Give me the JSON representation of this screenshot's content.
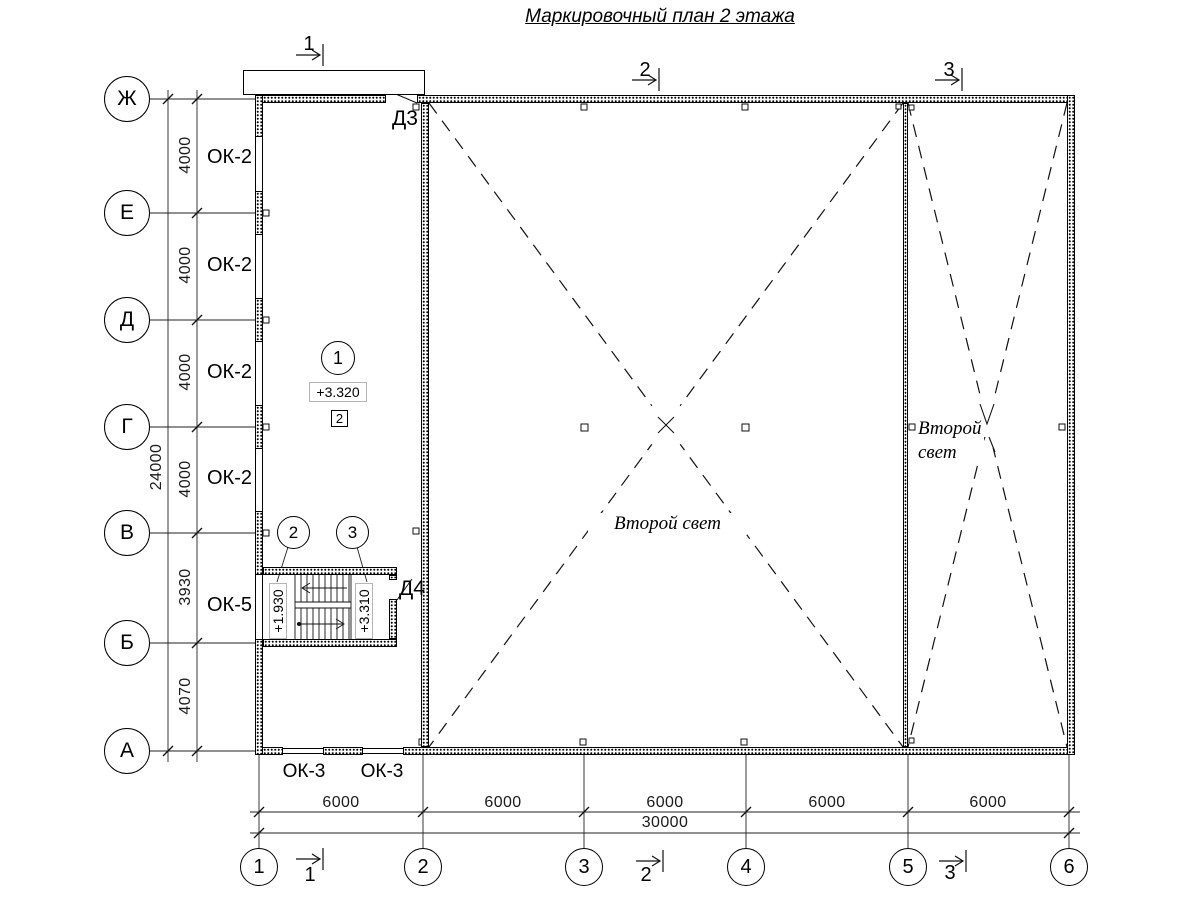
{
  "title": "Маркировочный план 2 этажа",
  "row_axis_labels": [
    "Ж",
    "Е",
    "Д",
    "Г",
    "В",
    "Б",
    "А"
  ],
  "col_axis_labels": [
    "1",
    "2",
    "3",
    "4",
    "5",
    "6"
  ],
  "left_dim_segments": [
    "4000",
    "4000",
    "4000",
    "4000",
    "3930",
    "4070"
  ],
  "left_dim_total": "24000",
  "bottom_dim_segments": [
    "6000",
    "6000",
    "6000",
    "6000",
    "6000"
  ],
  "bottom_dim_total": "30000",
  "section_marks_top": [
    "1",
    "2",
    "3"
  ],
  "section_marks_bottom": [
    "1",
    "2",
    "3"
  ],
  "window_labels_ok2": [
    "ОК-2",
    "ОК-2",
    "ОК-2",
    "ОК-2"
  ],
  "window_label_ok5": "ОК-5",
  "window_labels_ok3": [
    "ОК-3",
    "ОК-3"
  ],
  "door_labels": {
    "d3": "Д3",
    "d4": "Д4"
  },
  "room_texts": {
    "second_light_center": "Второй свет",
    "second_light_right": "Второй свет"
  },
  "marks": {
    "detail_circle": "1",
    "elevation_main": "+3.320",
    "node_square": "2",
    "stair_flight_low_circle": "2",
    "stair_flight_high_circle": "3",
    "elevation_stair_low": "+1.930",
    "elevation_stair_high": "+3.310"
  }
}
